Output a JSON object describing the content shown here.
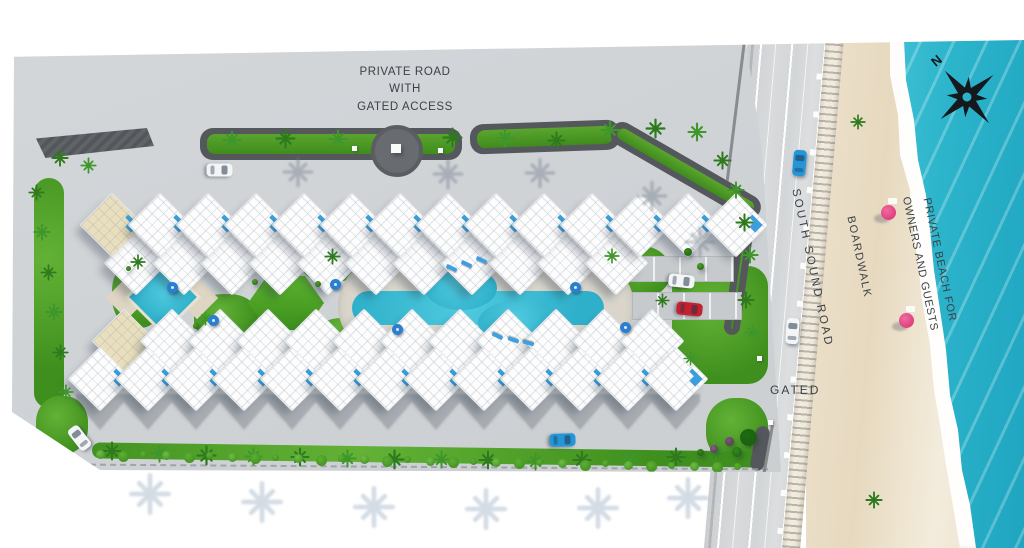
{
  "labels": {
    "private_road": [
      "PRIVATE ROAD",
      "WITH",
      "GATED ACCESS"
    ],
    "south_sound_road": "SOUTH SOUND ROAD",
    "boardwalk": "BOARDWALK",
    "private_beach": [
      "PRIVATE BEACH FOR",
      "OWNERS AND GUESTS"
    ],
    "gated": "GATED",
    "compass_north": "N"
  },
  "palette": {
    "water": "#2fb5cc",
    "surf": "#ffffff",
    "sand": "#ecdfc7",
    "road": "#d6d8da",
    "site_paving": "#ced2d5",
    "pool": "#3fbfd4",
    "lawn": "#4f9f27",
    "building_roof": "#fbfcfd",
    "rooftop_pool_accent": "#3e9edd",
    "beach_umbrella": "#e0427e",
    "pool_umbrella": "#2b7fd0",
    "curb": "#54585c",
    "label_text": "#3c4146"
  },
  "scene": {
    "building_rows": 2,
    "beach_umbrellas": 2,
    "pool_umbrellas": 6,
    "cars": [
      "white",
      "white",
      "red",
      "white",
      "blue",
      "blue",
      "white"
    ],
    "gated_entrances": 2
  }
}
